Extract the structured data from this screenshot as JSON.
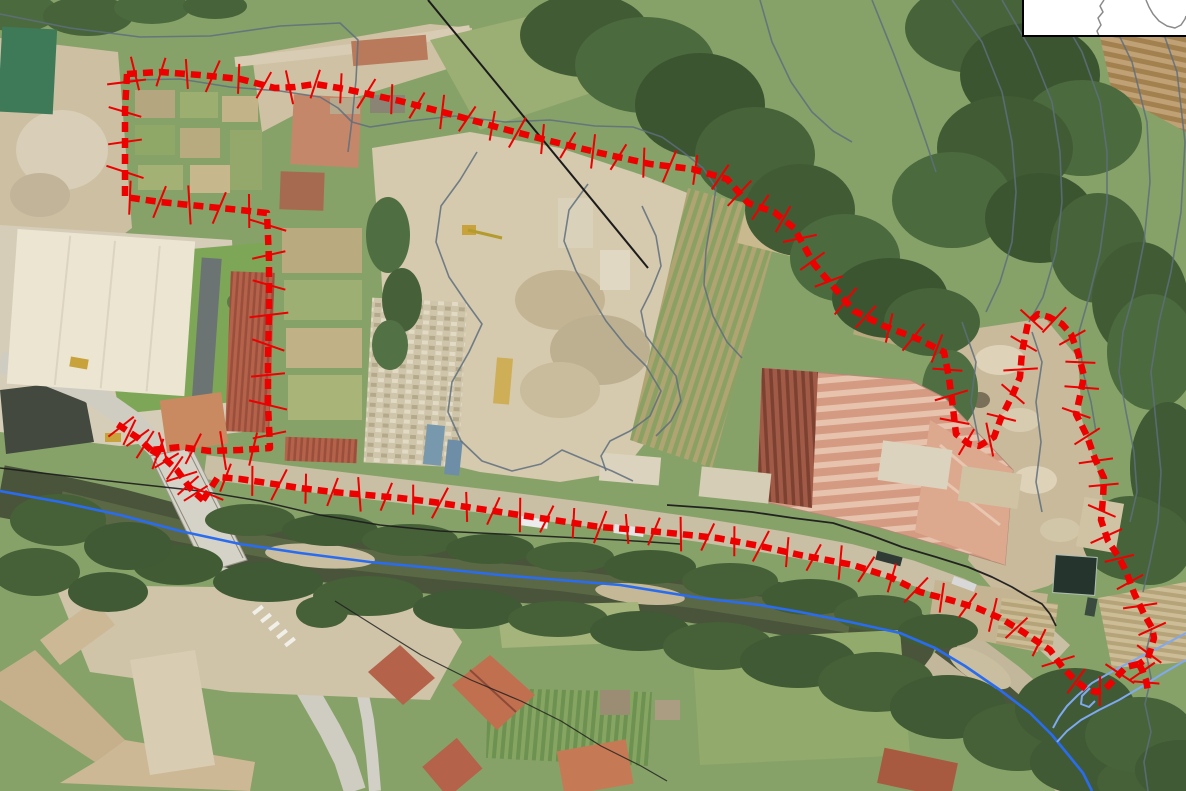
{
  "map": {
    "kind": "aerial-orthophoto-with-site-boundary-overlay",
    "width_px": 1186,
    "height_px": 791
  },
  "colors": {
    "boundary_red": "#ec0000",
    "river_blue": "#2a6cf0",
    "river_blue_light": "#7fa9f0",
    "contour_gray": "#5e6e7e",
    "utility_black": "#1c1c1c",
    "inset_bg": "#ffffff",
    "inset_border": "#000000",
    "inset_outline_gray": "#8a8a8a"
  },
  "boundary": {
    "stroke_width": 6.5,
    "dash": "10 6",
    "tick_width": 2,
    "paths": [
      {
        "name": "boundary-north-east-lobe",
        "tick_spacing": 26,
        "tick_length": 30,
        "points": "127,74 160,72 200,75 240,79 275,88 295,87 315,84 345,89 400,101 450,114 500,128 550,141 600,153 650,164 692,169 727,179 748,203 774,212 794,228 814,264 831,284 854,311 884,326 918,339 944,352 949,378 953,408 956,434 969,444 979,446 994,437 1001,418 1013,394 1020,377 1022,352 1028,323 1038,314 1049,317 1062,324 1071,334 1078,353 1084,376 1080,396 1076,414 1087,436 1095,459 1104,478 1103,498 1101,520 1108,541 1118,556 1126,571 1134,593 1144,614 1152,628 1154,638 1148,658 1139,664"
      },
      {
        "name": "boundary-west-side",
        "tick_spacing": 30,
        "tick_length": 34,
        "points": "127,74 125,110 125,150 125,197 160,202 200,206 240,210 267,213 269,260 269,310 268,360 268,405 270,448 240,450 210,451 180,447 151,450"
      },
      {
        "name": "boundary-south-along-river",
        "tick_spacing": 27,
        "tick_length": 30,
        "points": "203,500 218,477 240,479 267,483 300,488 333,492 367,495 400,498 433,502 467,507 500,512 533,517 567,522 600,527 640,530 680,534 717,538 760,546 800,555 827,560 853,565 890,577 920,592 950,600 977,608 1000,618 1020,630 1035,640 1050,650 1063,668 1076,681 1086,689 1096,692 1104,690 1114,680 1126,667 1139,664"
      },
      {
        "name": "boundary-bridge-diagonal",
        "tick_spacing": 11,
        "tick_length": 28,
        "points": "151,450 163,457 177,470 190,488 203,500"
      },
      {
        "name": "boundary-west-spur",
        "tick_spacing": 10,
        "tick_length": 28,
        "points": "151,450 138,438 126,430 114,422"
      },
      {
        "name": "boundary-southeast-tail",
        "tick_spacing": 12,
        "tick_length": 26,
        "points": "1139,664 1143,672 1146,680 1148,691"
      }
    ]
  },
  "rivers": {
    "paths": [
      {
        "name": "river-axis-main",
        "color": "river_blue",
        "width": 2.6,
        "points": "0,491 60,502 120,515 180,531 240,544 300,553 370,562 433,568 500,575 560,580 620,585 700,598 760,605 800,612 850,622 900,633 935,648 965,666 1000,690 1030,713 1052,735 1070,757 1083,773 1092,791"
      },
      {
        "name": "river-bank-upper",
        "color": "river_blue_light",
        "width": 2,
        "points": "1186,633 1160,647 1138,658 1113,671 1092,683 1078,695 1067,706 1059,717 1053,728"
      },
      {
        "name": "river-bank-lower",
        "color": "river_blue_light",
        "width": 2,
        "points": "1186,660 1162,674 1141,687 1119,700 1099,710 1081,720 1067,731 1057,742"
      },
      {
        "name": "river-meander-branch",
        "color": "river_blue_light",
        "width": 2,
        "points": "1090,688 1082,696 1081,704 1089,707 1095,701"
      }
    ]
  },
  "utilities": {
    "paths": [
      {
        "name": "power-line-diagonal",
        "width": 2,
        "opacity": 1,
        "points": "428,0 648,268"
      },
      {
        "name": "bank-line-west",
        "width": 1.5,
        "opacity": 0.9,
        "points": "0,468 100,480 200,491 260,501 320,515 380,525 440,531 500,534 560,537 620,540 680,544"
      },
      {
        "name": "road-line-east",
        "width": 1.8,
        "opacity": 0.95,
        "points": "667,505 710,508 752,512 793,518 833,523 870,535 902,547 936,557 968,567 992,577 1012,587 1027,596 1042,604 1050,614 1056,626"
      },
      {
        "name": "power-line-village",
        "width": 1.2,
        "opacity": 0.8,
        "points": "335,601 381,630 421,655 471,680 521,701 561,721 601,746 641,766 667,781"
      }
    ]
  },
  "contours": {
    "width": 1.6,
    "paths": [
      {
        "name": "contour-top-left-track",
        "points": "0,14 70,28 140,37 210,36 280,26 340,23 358,40 356,80 352,120 348,152"
      },
      {
        "name": "contour-garden-stream",
        "points": "130,80 180,79 230,87 280,91 320,97 338,108 352,122 370,127 410,121 455,116 505,122 550,120 595,126 633,127 662,137 683,152 703,168 716,188 712,215 706,250 704,285 713,316 727,342 742,358"
      },
      {
        "name": "contour-stockyard-outer",
        "points": "477,152 460,180 441,206 436,242 449,277 466,302 482,324 469,352 452,382 448,412 461,441 482,461 512,471 541,464 562,450 588,461 612,471 633,481"
      },
      {
        "name": "contour-stockyard-inner-1",
        "points": "588,184 569,210 564,241 576,271 591,296 606,321 626,346 646,366 661,391 650,416 630,431 610,441 601,456 606,471"
      },
      {
        "name": "contour-stockyard-inner-2",
        "points": "642,206 656,236 661,266 651,291 641,311 646,336 661,356 676,376 681,401 671,421 656,436"
      },
      {
        "name": "contour-forest-1",
        "points": "760,0 772,42 791,82 812,112 833,131 852,142"
      },
      {
        "name": "contour-forest-2",
        "points": "872,0 893,52 912,102 926,142 936,172"
      },
      {
        "name": "contour-hill-1",
        "points": "952,0 982,42 1002,92 1012,142 1016,192 1012,242 1000,282 986,312"
      },
      {
        "name": "contour-hill-2",
        "points": "1002,0 1032,52 1052,102 1060,152 1062,202 1056,252 1043,297 1029,322"
      },
      {
        "name": "contour-hill-3",
        "points": "1052,0 1082,52 1100,102 1107,152 1107,202 1100,252 1089,297 1079,332 1083,372 1091,402 1096,432"
      },
      {
        "name": "contour-hill-4",
        "points": "1102,0 1132,62 1147,122 1150,182 1144,242 1134,292 1123,332 1119,372 1126,412 1134,452 1137,492 1130,522"
      },
      {
        "name": "contour-hill-5",
        "points": "1152,0 1177,72 1185,142 1181,212 1171,272 1159,322 1151,372 1156,422 1161,472 1158,522 1150,562 1143,592"
      },
      {
        "name": "contour-quarry-1",
        "points": "962,322 976,362 971,402 979,442"
      },
      {
        "name": "contour-quarry-2",
        "points": "1032,332 1042,362 1036,402 1041,442 1036,482 1042,512"
      },
      {
        "name": "contour-southeast-wavy",
        "points": "1152,628 1146,652 1151,678 1145,704 1151,732 1144,762 1148,791"
      }
    ]
  },
  "inset": {
    "frame": {
      "x": 1022,
      "y": 0,
      "width": 164,
      "height": 36
    },
    "border_width": 2,
    "outline_paths": [
      {
        "name": "inset-outline-left",
        "points": "1104,0 1100,6 1103,12 1098,18 1101,25 1097,31 1099,36"
      },
      {
        "name": "inset-outline-right",
        "points": "1146,0 1149,7 1153,14 1159,21 1167,26 1175,28 1181,25 1185,19 1186,16"
      }
    ]
  }
}
